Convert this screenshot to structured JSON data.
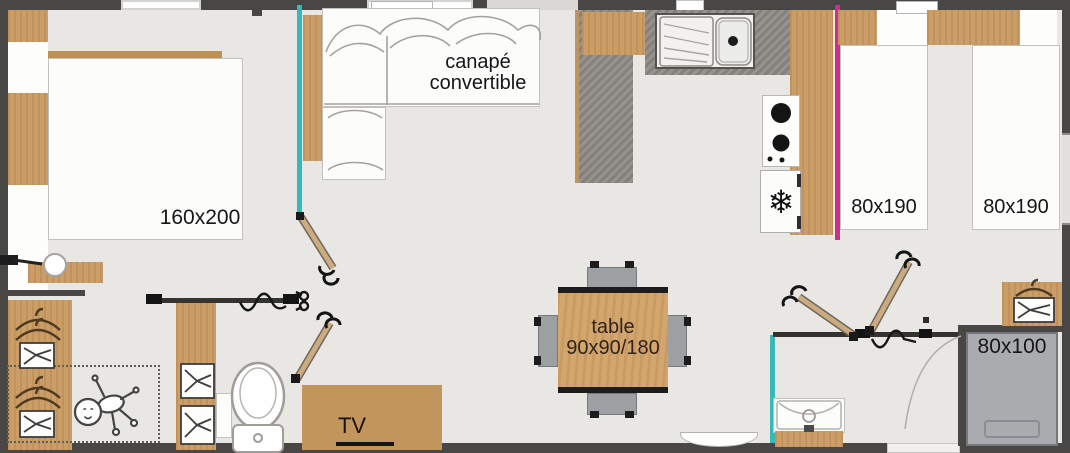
{
  "type": "mobile-home-floor-plan",
  "labels": {
    "master_bed": "160x200",
    "sofa_line1": "canapé",
    "sofa_line2": "convertible",
    "twin_bed_left": "80x190",
    "twin_bed_right": "80x190",
    "small_bed": "80x100",
    "table_line1": "table",
    "table_line2": "90x90/180",
    "tv": "TV"
  },
  "icons": {
    "snowflake": "❄"
  },
  "colors": {
    "wall": "#494745",
    "floor": "#e9e7e4",
    "wood": "#cb9e67",
    "counter_gray": "#8e8a86",
    "partition_teal": "#36b9b9",
    "partition_magenta": "#cd2e89",
    "furniture_white": "#fcfcfb",
    "small_bed_gray": "#a9abae"
  }
}
